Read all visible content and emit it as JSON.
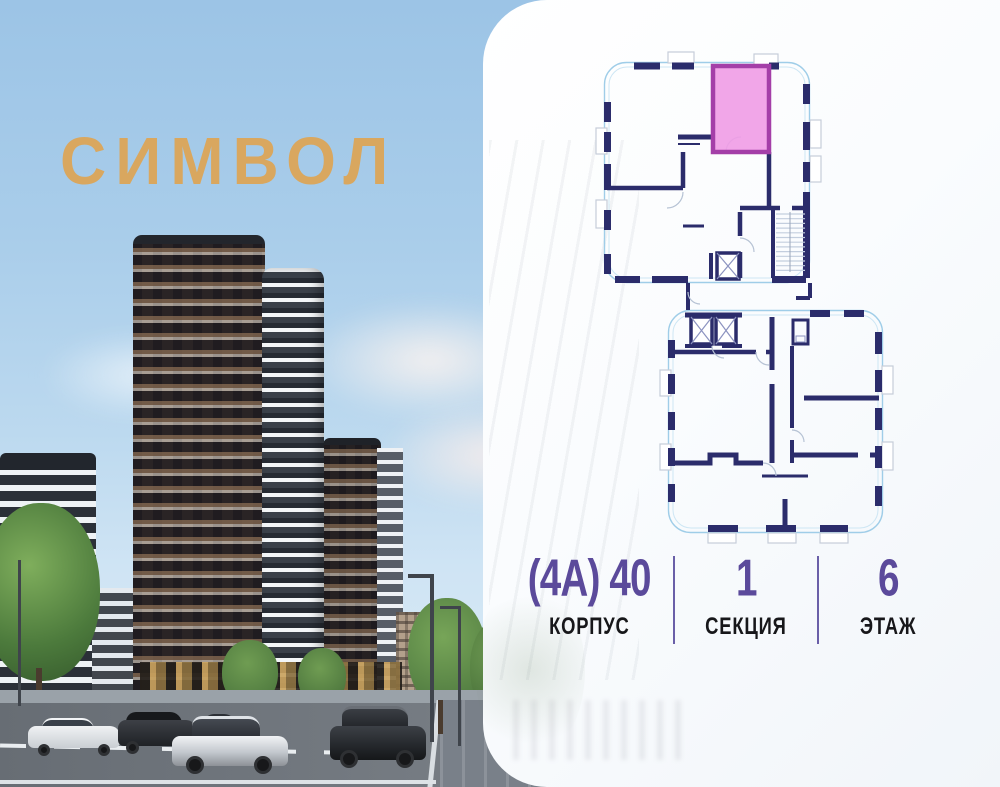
{
  "brand": {
    "logo_text": "СИМВОЛ",
    "logo_color": "#D9A75F"
  },
  "floor_plan": {
    "highlighted_unit": {
      "fill": "#EF9CE5",
      "border": "#A43FA8"
    },
    "wall_color": "#2B2C6B",
    "outline_color": "#9FCDE8",
    "sections_shown": 2
  },
  "info": {
    "value_color": "#5B4A9B",
    "divider_color": "#6A5FA8",
    "items": [
      {
        "value": "(4A) 40",
        "label": "КОРПУС"
      },
      {
        "value": "1",
        "label": "СЕКЦИЯ"
      },
      {
        "value": "6",
        "label": "ЭТАЖ"
      }
    ]
  }
}
